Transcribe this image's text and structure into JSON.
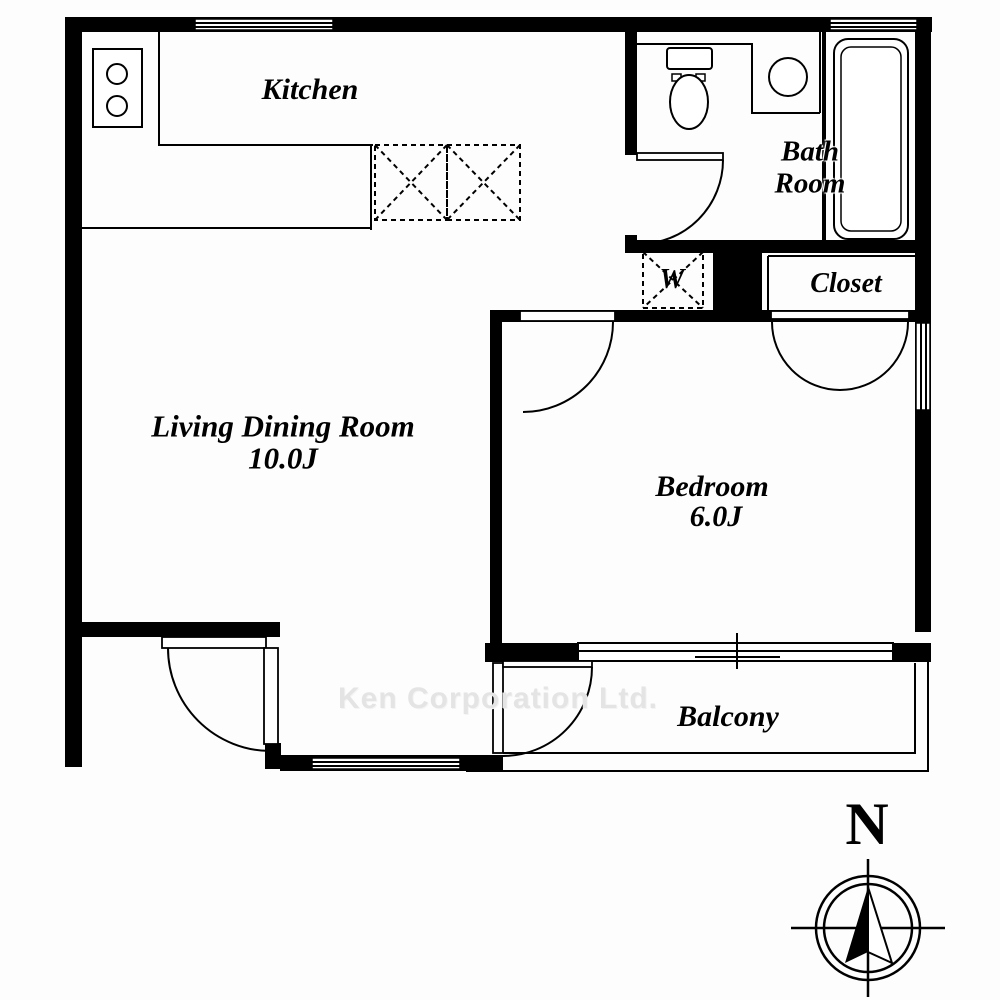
{
  "rooms": {
    "kitchen": {
      "label": "Kitchen"
    },
    "living_dining": {
      "label": "Living Dining Room",
      "size": "10.0J"
    },
    "bedroom": {
      "label": "Bedroom",
      "size": "6.0J"
    },
    "bathroom": {
      "label_line1": "Bath",
      "label_line2": "Room"
    },
    "closet": {
      "label": "Closet"
    },
    "washer_space": {
      "label": "W"
    },
    "balcony": {
      "label": "Balcony"
    }
  },
  "compass": {
    "north_label": "N"
  },
  "watermark": {
    "text": "Ken Corporation Ltd."
  },
  "colors": {
    "wall": "#000000",
    "line": "#000000",
    "background": "#fdfdfd",
    "watermark_gray": "#e4e4e4"
  }
}
